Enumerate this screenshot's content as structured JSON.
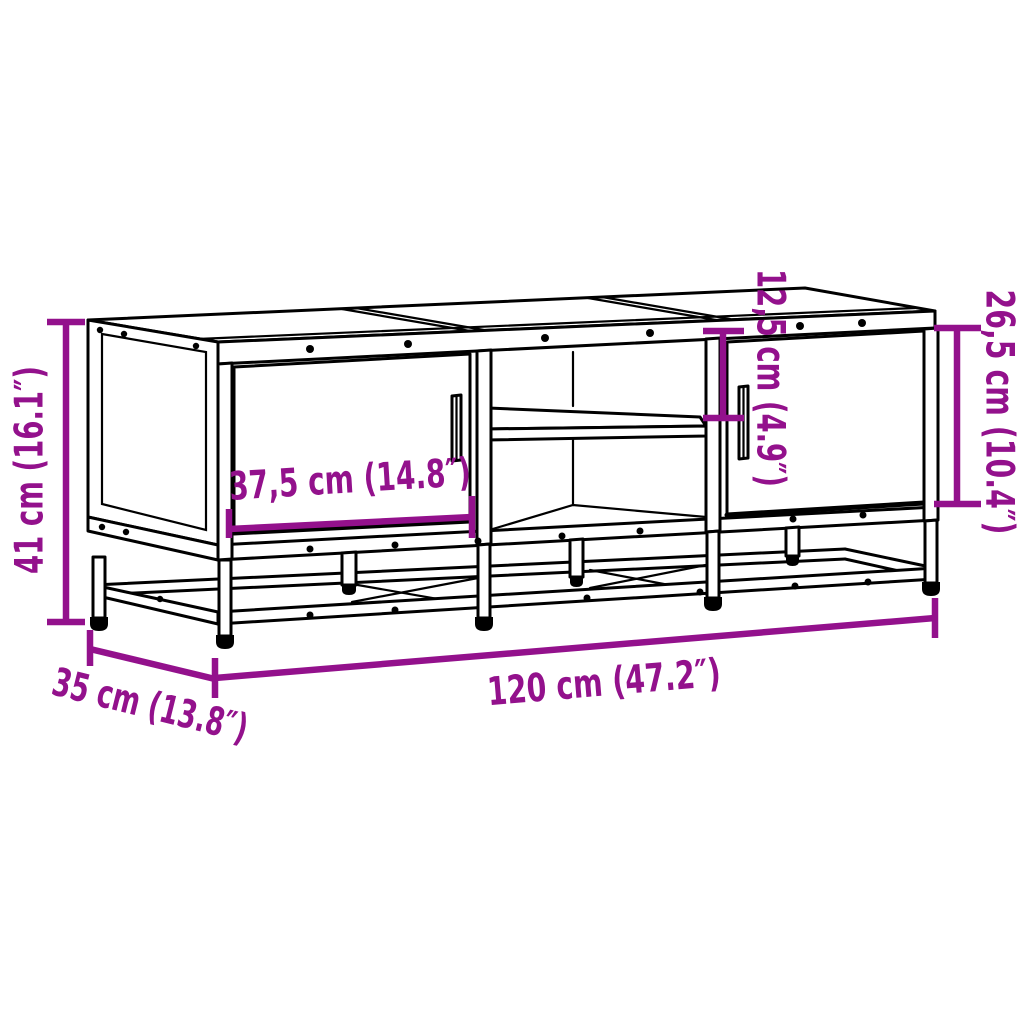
{
  "diagram": {
    "type": "furniture-dimension-drawing",
    "subject": "TV stand with two doors, open middle shelf and metal base frame",
    "colors": {
      "dimension": "#93118C",
      "outline": "#000000",
      "background": "#FFFFFF"
    },
    "labels": {
      "overall_height": "41 cm (16.1″)",
      "door_width": "37,5 cm (14.8″)",
      "upper_compartment_height": "12,5 cm (4.9″)",
      "door_height": "26,5 cm (10.4″)",
      "overall_width": "120 cm (47.2″)",
      "overall_depth": "35 cm (13.8″)"
    }
  }
}
